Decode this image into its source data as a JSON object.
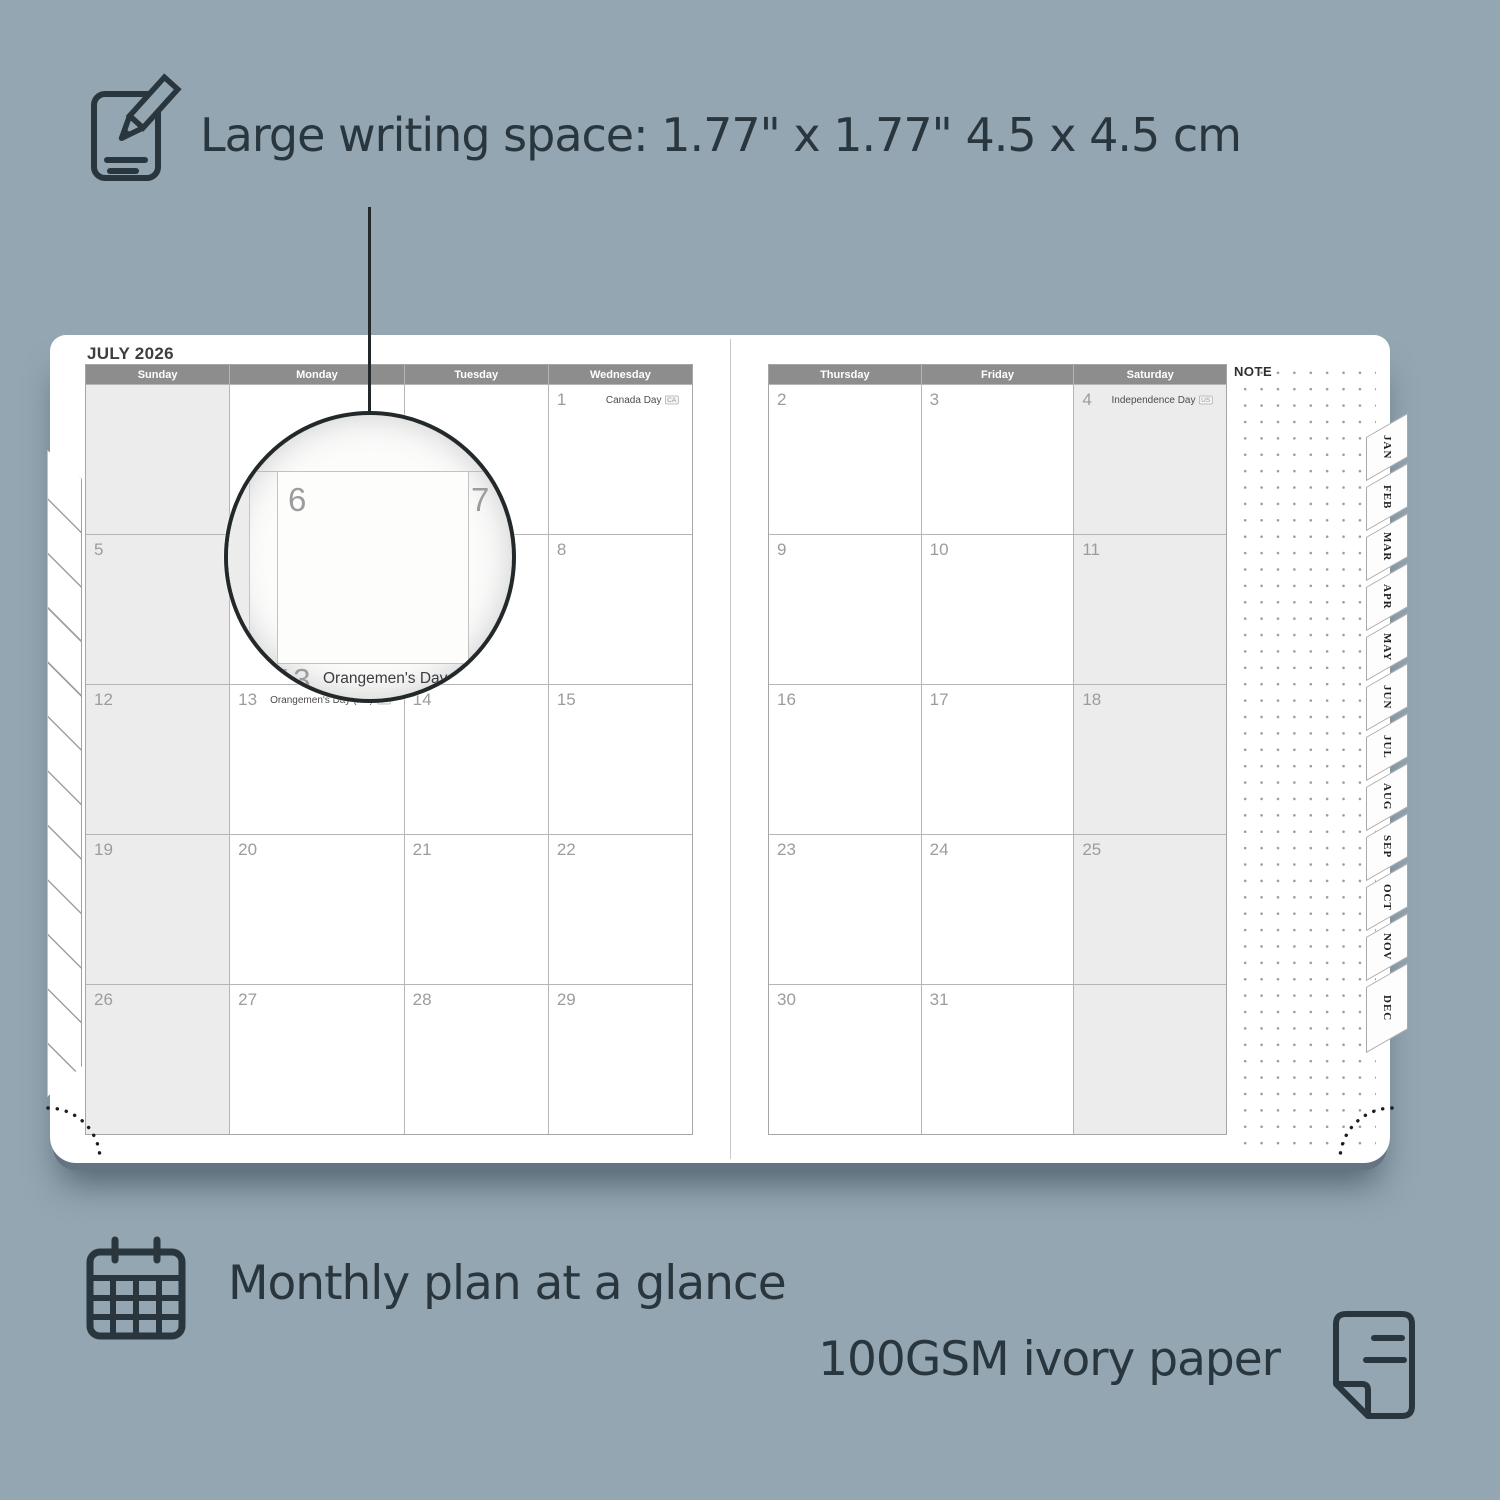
{
  "top_callout": {
    "text": "Large writing space: 1.77\" x 1.77\" 4.5 x 4.5 cm"
  },
  "magnifier": {
    "day_left": "6",
    "day_right": "7",
    "day_below": "13",
    "holiday": "Orangemen's Day (n.i.)",
    "holiday_badge": "UK"
  },
  "planner": {
    "month_title": "JULY 2026",
    "note_label": "NOTE",
    "left_day_headers": [
      "Sunday",
      "Monday",
      "Tuesday",
      "Wednesday"
    ],
    "right_day_headers": [
      "Thursday",
      "Friday",
      "Saturday"
    ],
    "left_shaded_cols": [
      0
    ],
    "right_shaded_cols": [
      2
    ],
    "left_weeks": [
      [
        {
          "num": ""
        },
        {
          "num": ""
        },
        {
          "num": ""
        },
        {
          "num": "1",
          "holiday": "Canada Day",
          "badge": "CA",
          "align": "right"
        }
      ],
      [
        {
          "num": "5"
        },
        {
          "num": "6"
        },
        {
          "num": "7"
        },
        {
          "num": "8"
        }
      ],
      [
        {
          "num": "12"
        },
        {
          "num": "13",
          "holiday": "Orangemen's Day (n.i.)",
          "badge": "UK",
          "align": "left"
        },
        {
          "num": "14"
        },
        {
          "num": "15"
        }
      ],
      [
        {
          "num": "19"
        },
        {
          "num": "20"
        },
        {
          "num": "21"
        },
        {
          "num": "22"
        }
      ],
      [
        {
          "num": "26"
        },
        {
          "num": "27"
        },
        {
          "num": "28"
        },
        {
          "num": "29"
        }
      ]
    ],
    "right_weeks": [
      [
        {
          "num": "2"
        },
        {
          "num": "3"
        },
        {
          "num": "4",
          "holiday": "Independence Day",
          "badge": "US",
          "align": "right"
        }
      ],
      [
        {
          "num": "9"
        },
        {
          "num": "10"
        },
        {
          "num": "11"
        }
      ],
      [
        {
          "num": "16"
        },
        {
          "num": "17"
        },
        {
          "num": "18"
        }
      ],
      [
        {
          "num": "23"
        },
        {
          "num": "24"
        },
        {
          "num": "25"
        }
      ],
      [
        {
          "num": "30"
        },
        {
          "num": "31"
        },
        {
          "num": ""
        }
      ]
    ],
    "month_tabs": [
      "JAN",
      "FEB",
      "MAR",
      "APR",
      "MAY",
      "JUN",
      "JUL",
      "AUG",
      "SEP",
      "OCT",
      "NOV",
      "DEC"
    ]
  },
  "bottom_features": {
    "monthly_text": "Monthly plan at a glance",
    "paper_text": "100GSM ivory paper"
  },
  "colors": {
    "background": "#93a6b2",
    "ink": "#2a363d",
    "header_gray": "#8d8d8d",
    "shaded_cell": "#ececec",
    "grid_line": "#b5b5b5",
    "date_number": "#9c9c9c",
    "page": "#ffffff"
  }
}
